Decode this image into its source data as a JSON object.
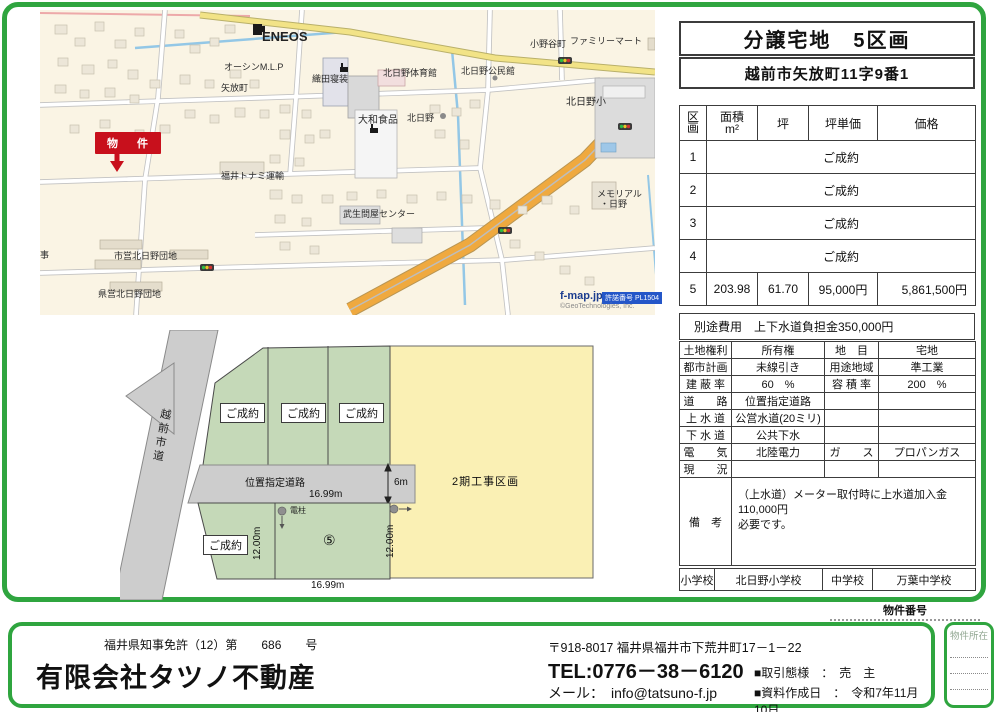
{
  "colors": {
    "accent_green": "#2FA53F",
    "plot_green": "#c5d9b8",
    "phase2_yellow": "#faf0b4",
    "road_gray": "#cdcdcd",
    "marker_red": "#c8101c"
  },
  "header": {
    "title": "分譲宅地　5区画",
    "address": "越前市矢放町11字9番1"
  },
  "price_table": {
    "headers": {
      "plot": "区画",
      "area1": "面積",
      "area2": "m²",
      "tsubo": "坪",
      "unit_price": "坪単価",
      "price": "価格"
    },
    "rows": [
      {
        "no": "1",
        "status": "ご成約"
      },
      {
        "no": "2",
        "status": "ご成約"
      },
      {
        "no": "3",
        "status": "ご成約"
      },
      {
        "no": "4",
        "status": "ご成約"
      },
      {
        "no": "5",
        "area": "203.98",
        "tsubo": "61.70",
        "unit_price": "95,000円",
        "price": "5,861,500円"
      }
    ],
    "extra_fee": "別途費用　上下水道負担金350,000円"
  },
  "details": {
    "rows": [
      {
        "l1": "土地権利",
        "v1": "所有権",
        "l2": "地　目",
        "v2": "宅地"
      },
      {
        "l1": "都市計画",
        "v1": "未線引き",
        "l2": "用途地域",
        "v2": "準工業"
      },
      {
        "l1": "建 蔽 率",
        "v1": "60　%",
        "l2": "容 積 率",
        "v2": "200　%"
      },
      {
        "l1": "道　　路",
        "v1": "位置指定道路",
        "l2": "",
        "v2": ""
      },
      {
        "l1": "上 水 道",
        "v1": "公営水道(20ミリ)",
        "l2": "",
        "v2": ""
      },
      {
        "l1": "下 水 道",
        "v1": "公共下水",
        "l2": "",
        "v2": ""
      },
      {
        "l1": "電　　気",
        "v1": "北陸電力",
        "l2": "ガ　　ス",
        "v2": "プロパンガス"
      },
      {
        "l1": "現　　況",
        "v1": "",
        "l2": "",
        "v2": ""
      }
    ],
    "remarks_label": "備　考",
    "remarks_line1": "（上水道）メーター取付時に上水道加入金110,000円",
    "remarks_line2": "必要です。"
  },
  "schools": {
    "elem_label": "小学校",
    "elem": "北日野小学校",
    "jhs_label": "中学校",
    "jhs": "万葉中学校"
  },
  "map": {
    "labels": [
      {
        "id": "label-eneos",
        "text": "ENEOS",
        "x": 262,
        "y": 29,
        "cls": "m12"
      },
      {
        "id": "label-oshin-mlp",
        "text": "オーシンM.L.P",
        "x": 224,
        "y": 60,
        "cls": "m9"
      },
      {
        "id": "label-oda-shinso",
        "text": "織田寝装",
        "x": 312,
        "y": 72,
        "cls": "m9"
      },
      {
        "id": "label-yahana-cho",
        "text": "矢放町",
        "x": 221,
        "y": 81,
        "cls": "m9"
      },
      {
        "id": "label-kitahino-gym",
        "text": "北日野体育館",
        "x": 383,
        "y": 66,
        "cls": "m9"
      },
      {
        "id": "label-kitahino-hall",
        "text": "北日野公民館",
        "x": 461,
        "y": 64,
        "cls": "m9"
      },
      {
        "id": "label-onodani-cho",
        "text": "小野谷町",
        "x": 530,
        "y": 37,
        "cls": "m9"
      },
      {
        "id": "label-familymart",
        "text": "ファミリーマート",
        "x": 570,
        "y": 34,
        "cls": "m9"
      },
      {
        "id": "label-kitahino-elem",
        "text": "北日野小",
        "x": 566,
        "y": 93,
        "cls": "m10"
      },
      {
        "id": "label-yamato-foods",
        "text": "大和食品",
        "x": 358,
        "y": 111,
        "cls": "m10"
      },
      {
        "id": "label-kitahino-station",
        "text": "北日野",
        "x": 407,
        "y": 111,
        "cls": "m9"
      },
      {
        "id": "label-tonami-transport",
        "text": "福井トナミ運輸",
        "x": 221,
        "y": 169,
        "cls": "m9"
      },
      {
        "id": "label-tonya-center",
        "text": "武生問屋センター",
        "x": 343,
        "y": 207,
        "cls": "m9"
      },
      {
        "id": "label-shiei-danchi",
        "text": "市営北日野団地",
        "x": 114,
        "y": 249,
        "cls": "m9"
      },
      {
        "id": "label-kenei-danchi",
        "text": "県営北日野団地",
        "x": 98,
        "y": 287,
        "cls": "m9"
      },
      {
        "id": "label-memorial-hino-1",
        "text": "メモリアル",
        "x": 597,
        "y": 187,
        "cls": "m9"
      },
      {
        "id": "label-memorial-hino-2",
        "text": "・日野",
        "x": 600,
        "y": 197,
        "cls": "m9"
      },
      {
        "id": "label-partial",
        "text": "事",
        "x": 40,
        "y": 248,
        "cls": "m9"
      },
      {
        "id": "property-marker",
        "text": "物　件",
        "x": 95,
        "y": 132,
        "cls": "badge"
      },
      {
        "id": "map-brand",
        "text": "f-map.jp",
        "x": 560,
        "y": 290,
        "cls": "fmap"
      },
      {
        "id": "map-license-badge",
        "text": "許諾番号 PL1504",
        "x": 602,
        "y": 292,
        "cls": "fbadge"
      },
      {
        "id": "map-copyright",
        "text": "©GeoTechnologies, Inc.",
        "x": 560,
        "y": 303,
        "cls": "copy"
      }
    ]
  },
  "siteplan": {
    "labels": [
      {
        "id": "plot1-status",
        "text": "ご成約",
        "x": 220,
        "y": 403,
        "cls": "box"
      },
      {
        "id": "plot2-status",
        "text": "ご成約",
        "x": 281,
        "y": 403,
        "cls": "box"
      },
      {
        "id": "plot3-status",
        "text": "ご成約",
        "x": 339,
        "y": 403,
        "cls": "box"
      },
      {
        "id": "plot4-status",
        "text": "ご成約",
        "x": 203,
        "y": 535,
        "cls": "box"
      },
      {
        "id": "plot5-number",
        "text": "⑤",
        "x": 323,
        "y": 532,
        "cls": "p14"
      },
      {
        "id": "phase2-label",
        "text": "2期工事区画",
        "x": 452,
        "y": 473,
        "cls": "p11"
      },
      {
        "id": "designated-road-label",
        "text": "位置指定道路",
        "x": 245,
        "y": 474,
        "cls": "p10"
      },
      {
        "id": "dim-top",
        "text": "16.99m",
        "x": 309,
        "y": 489,
        "cls": "p10"
      },
      {
        "id": "dim-bottom",
        "text": "16.99m",
        "x": 311,
        "y": 580,
        "cls": "p10"
      },
      {
        "id": "dim-6m",
        "text": "6m",
        "x": 394,
        "y": 477,
        "cls": "p10"
      },
      {
        "id": "dim-12m-left",
        "text": "12.00m",
        "x": 252,
        "y": 560,
        "cls": "rot"
      },
      {
        "id": "dim-12m-right",
        "text": "12.00m",
        "x": 385,
        "y": 558,
        "cls": "rot"
      },
      {
        "id": "utility-pole-label",
        "text": "電柱",
        "x": 290,
        "y": 505,
        "cls": "p8"
      },
      {
        "id": "city-road-label",
        "text": "越前市道",
        "x": 153,
        "y": 408,
        "cls": "vroad"
      }
    ]
  },
  "footer": {
    "license_line": "福井県知事免許（12）第　　686　　号",
    "company": "有限会社タツノ不動産",
    "address": "〒918-8017 福井県福井市下荒井町17－1－22",
    "tel": "TEL:0776－38－6120",
    "mail": "メール：　info@tatsuno-f.jp",
    "deal_type": "■取引態様　：　売　主",
    "created": "■資料作成日　：　令和7年11月10日",
    "property_no_label": "物件番号",
    "property_loc_label": "物件所在"
  }
}
